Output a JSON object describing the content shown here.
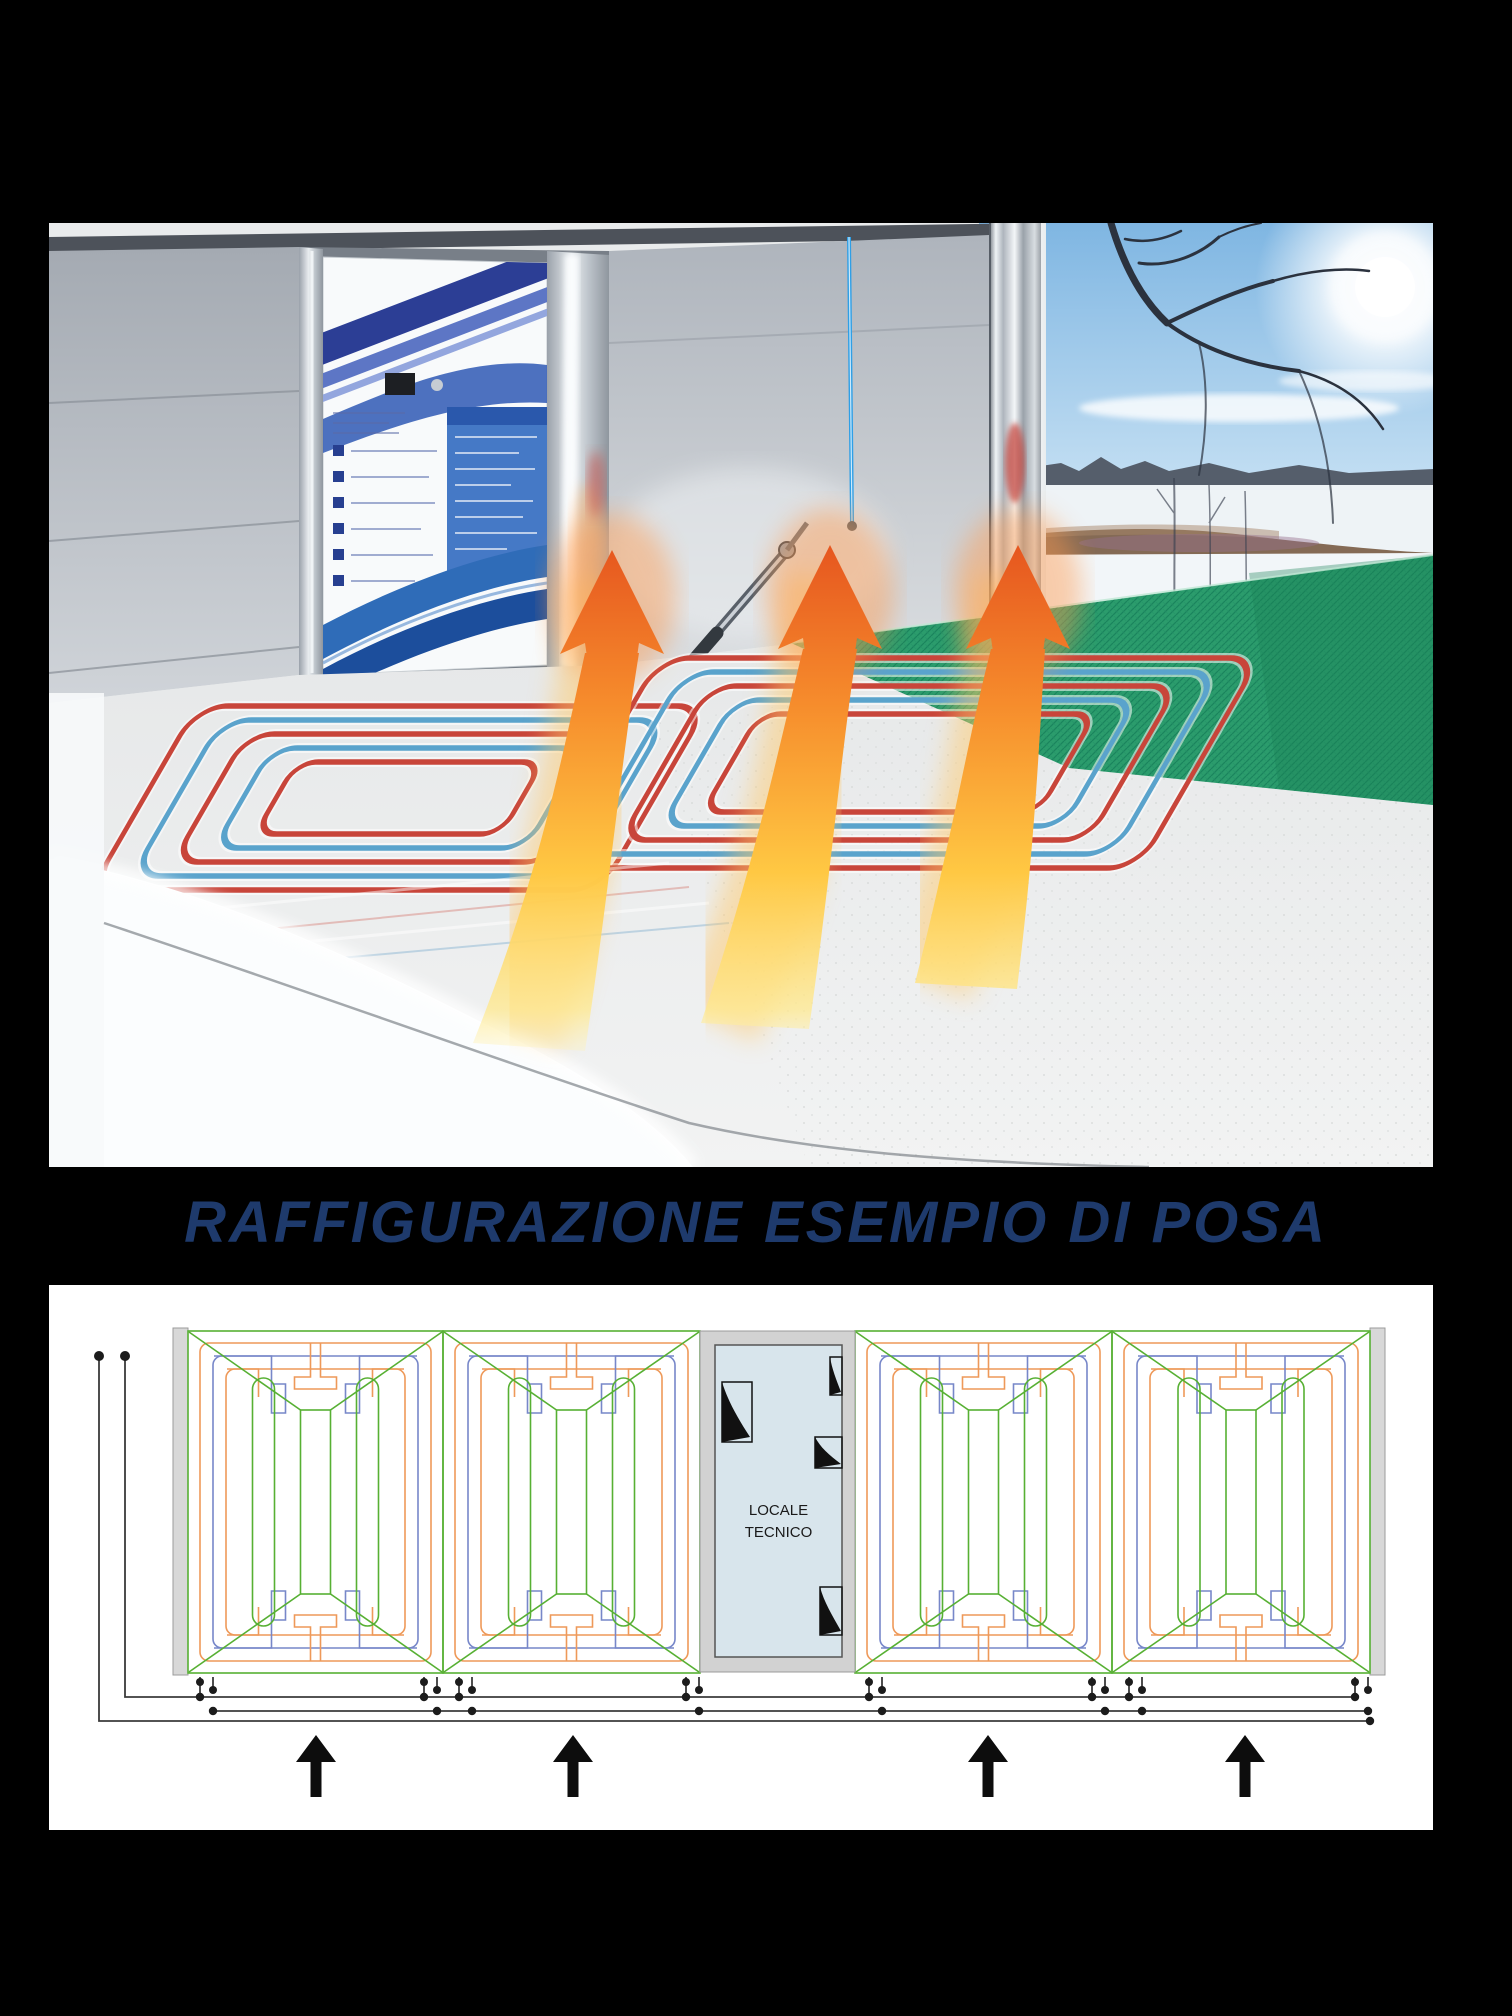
{
  "title": {
    "text": "RAFFIGURAZIONE ESEMPIO DI POSA",
    "color": "#1e3a6c"
  },
  "photo": {
    "subject": "winter car-wash bay with underfloor heating pipes and rising heat arrows",
    "colors": {
      "sky": "#7fb6e2",
      "building_wall": "#b6bbc3",
      "grate_mat_green": "#2b9c6c",
      "pipe_red": "#c8453a",
      "pipe_blue": "#5aa3cc",
      "heat_arrow_orange": "#f68c2c",
      "heat_arrow_yellow": "#ffd84d"
    }
  },
  "diagram": {
    "room": {
      "label_line1": "LOCALE",
      "label_line2": "TECNICO",
      "fill": "#d8e5ec",
      "wall_gray": "#d2d2d2"
    },
    "colors": {
      "circuit_green": "#57b033",
      "circuit_orange": "#ee9959",
      "circuit_blue": "#7787c9",
      "side_wall_gray": "#d8d8d8",
      "line_black": "#3b3b3b"
    },
    "panel_count": 4,
    "tap_pair_count": 8,
    "inlet_arrow_count": 4
  }
}
